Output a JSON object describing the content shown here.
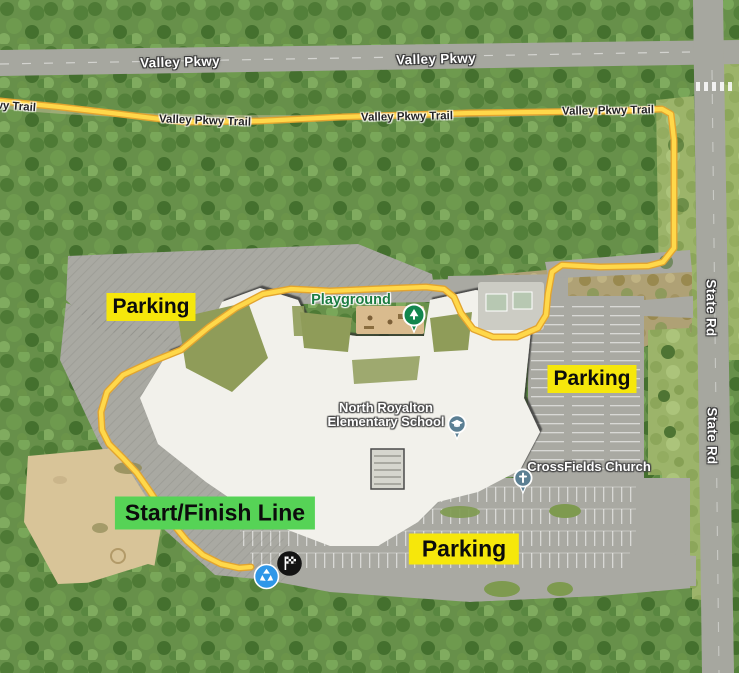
{
  "map": {
    "road_labels": {
      "valley_pkwy_1": "Valley Pkwy",
      "valley_pkwy_2": "Valley Pkwy",
      "state_rd_1": "State Rd",
      "state_rd_2": "State Rd"
    },
    "trail_labels": {
      "partial": "Valley Pkwy Trail",
      "t1": "Valley Pkwy Trail",
      "t2": "Valley Pkwy Trail",
      "t3": "Valley Pkwy Trail"
    },
    "poi_labels": {
      "playground": "Playground",
      "school_line1": "North Royalton",
      "school_line2": "Elementary School",
      "church": "CrossFields Church"
    },
    "overlays": {
      "parking_left": "Parking",
      "parking_right": "Parking",
      "parking_bottom": "Parking",
      "start_finish": "Start/Finish Line"
    },
    "icons": {
      "playground_pin": "tree-pin-icon",
      "school_pin": "graduation-cap-pin-icon",
      "church_pin": "cross-pin-icon",
      "recycle_marker": "recycle-marker-icon",
      "finish_flag": "checkered-flag-icon"
    },
    "colors": {
      "route_yellow": "#FFD84A",
      "route_edge": "#E2A42F",
      "parking_tag_bg": "#F6E70B",
      "start_finish_bg": "#56D356",
      "playground_pin": "#12864E",
      "poi_pin_blue_gray": "#5B7F93",
      "recycle_blue": "#2F97E8",
      "finish_circle": "#141414"
    }
  }
}
